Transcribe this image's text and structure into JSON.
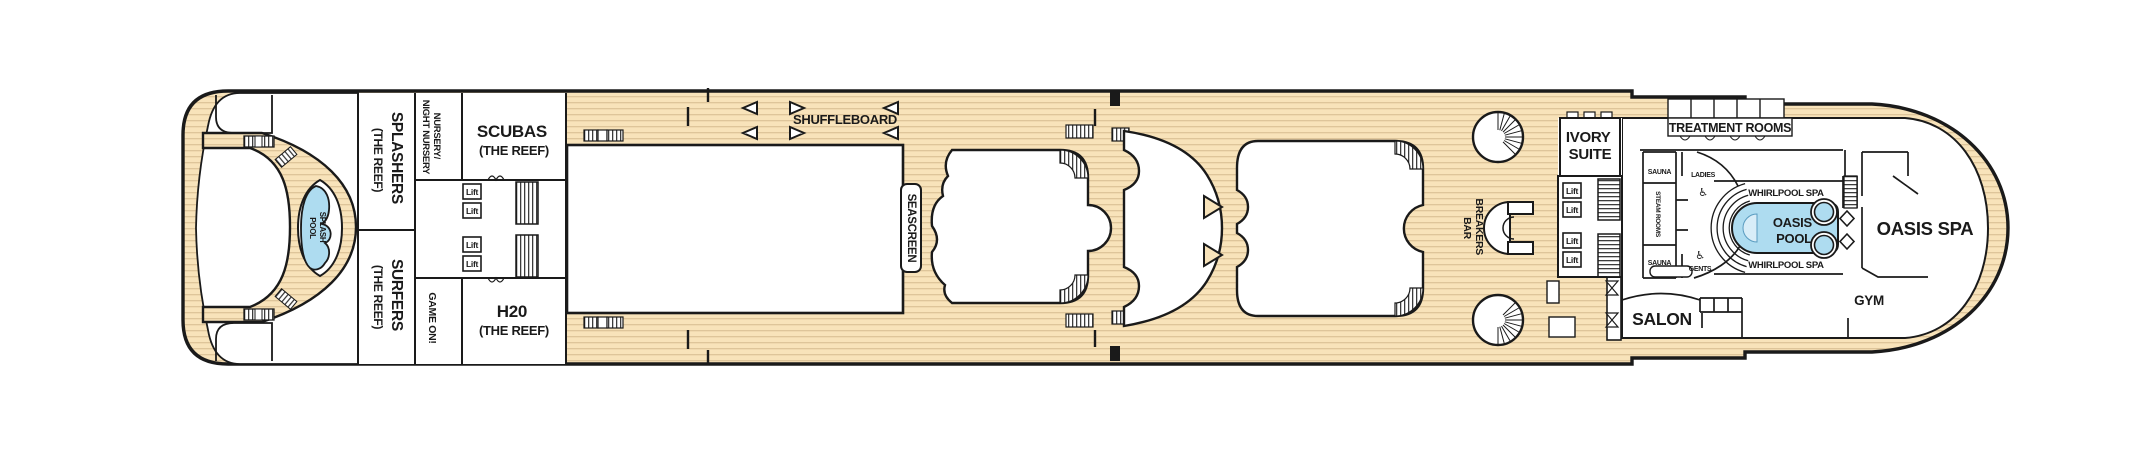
{
  "colors": {
    "deck": "#f8e3ba",
    "plank_line": "#dcc296",
    "outline": "#1a1a1a",
    "pool_fill": "#aedcf0",
    "pool_light": "#d8edf8",
    "interior": "#ffffff"
  },
  "stern": {
    "splash_pool": [
      "SPLASH",
      "POOL"
    ],
    "splashers": {
      "name": "SPLASHERS",
      "sub": "(THE REEF)"
    },
    "surfers": {
      "name": "SURFERS",
      "sub": "(THE REEF)"
    }
  },
  "kids_zone": {
    "nursery": [
      "NURSERY/",
      "NIGHT NURSERY"
    ],
    "game_on": "GAME ON!",
    "scubas": {
      "name": "SCUBAS",
      "sub": "(THE REEF)"
    },
    "h2o": {
      "name": "H20",
      "sub": "(THE REEF)"
    }
  },
  "deck_features": {
    "shuffleboard": "SHUFFLEBOARD",
    "seascreen": "SEASCREEN",
    "breakers_bar": [
      "BREAKERS",
      "BAR"
    ]
  },
  "lift_label": "Lift",
  "spa": {
    "ivory_suite": [
      "IVORY",
      "SUITE"
    ],
    "treatment_rooms": "TREATMENT ROOMS",
    "sauna_top": "SAUNA",
    "steam_rooms": "STEAM ROOMS",
    "sauna_bottom": "SAUNA",
    "ladies": "LADIES",
    "gents": "GENTS",
    "whirlpool_spa_top": "WHIRLPOOL SPA",
    "whirlpool_spa_bottom": "WHIRLPOOL SPA",
    "oasis_pool": [
      "OASIS",
      "POOL"
    ],
    "oasis_spa": "OASIS SPA",
    "salon": "SALON",
    "gym": "GYM"
  },
  "icons": {
    "wheelchair": "♿"
  }
}
